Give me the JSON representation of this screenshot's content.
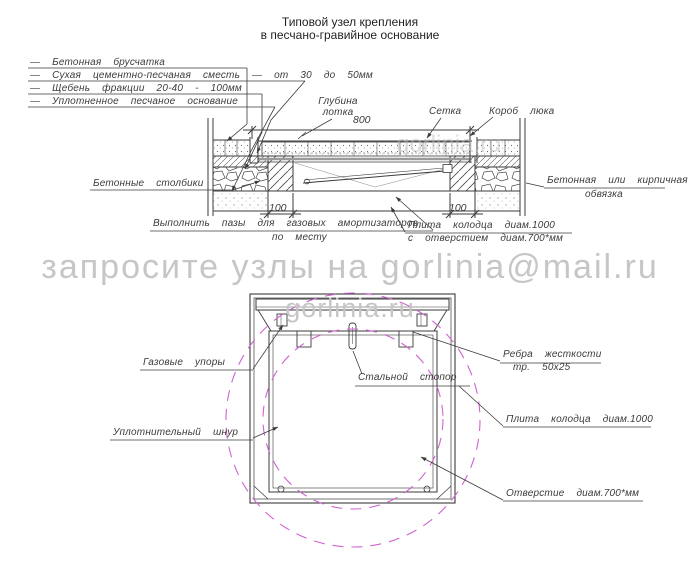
{
  "title": {
    "line1": "Типовой узел крепления",
    "line2": "в песчано-гравийное основание"
  },
  "legend": {
    "items": [
      {
        "label": "—  Бетонная  брусчатка"
      },
      {
        "label": "—  Сухая  цементно-песчаная  сместь  —  от  30  до  50мм"
      },
      {
        "label": "—  Щебень  фракции  20-40  -  100мм"
      },
      {
        "label": "—  Уплотненное  песчаное  основание"
      }
    ]
  },
  "section": {
    "dims": {
      "width": "800",
      "pillar_left": "100",
      "pillar_right": "100"
    },
    "labels": {
      "depth_line1": "Глубина",
      "depth_line2": "лотка",
      "mesh": "Сетка",
      "hatch_box": "Короб  люка",
      "pillars": "Бетонные  столбики",
      "frame_line1": "Бетонная  или  кирпичная",
      "frame_line2": "обвязка",
      "grooves_line1": "Выполнить  пазы  для  газовых  амортизаторов",
      "grooves_line2": "по  месту",
      "slab_line1": "Плита  колодца  диам.1000",
      "slab_line2": "с  отверстием  диам.700*мм"
    }
  },
  "plan": {
    "labels": {
      "gas_struts": "Газовые  упоры",
      "stopper": "Стальной  стопор",
      "ribs_line1": "Ребра  жесткости",
      "ribs_line2": "тр.  50х25",
      "cord": "Уплотнительный  шнур",
      "slab": "Плита  колодца  диам.1000",
      "hole": "Отверстие  диам.700*мм"
    }
  },
  "watermark": {
    "request_text": "запросите узлы на gorlinia@mail.ru",
    "site_text": "gorlinia.ru"
  },
  "colors": {
    "line": "#3b3b3b",
    "magenta": "#cf63cf",
    "watermark_gray": "#c6c6c6"
  }
}
